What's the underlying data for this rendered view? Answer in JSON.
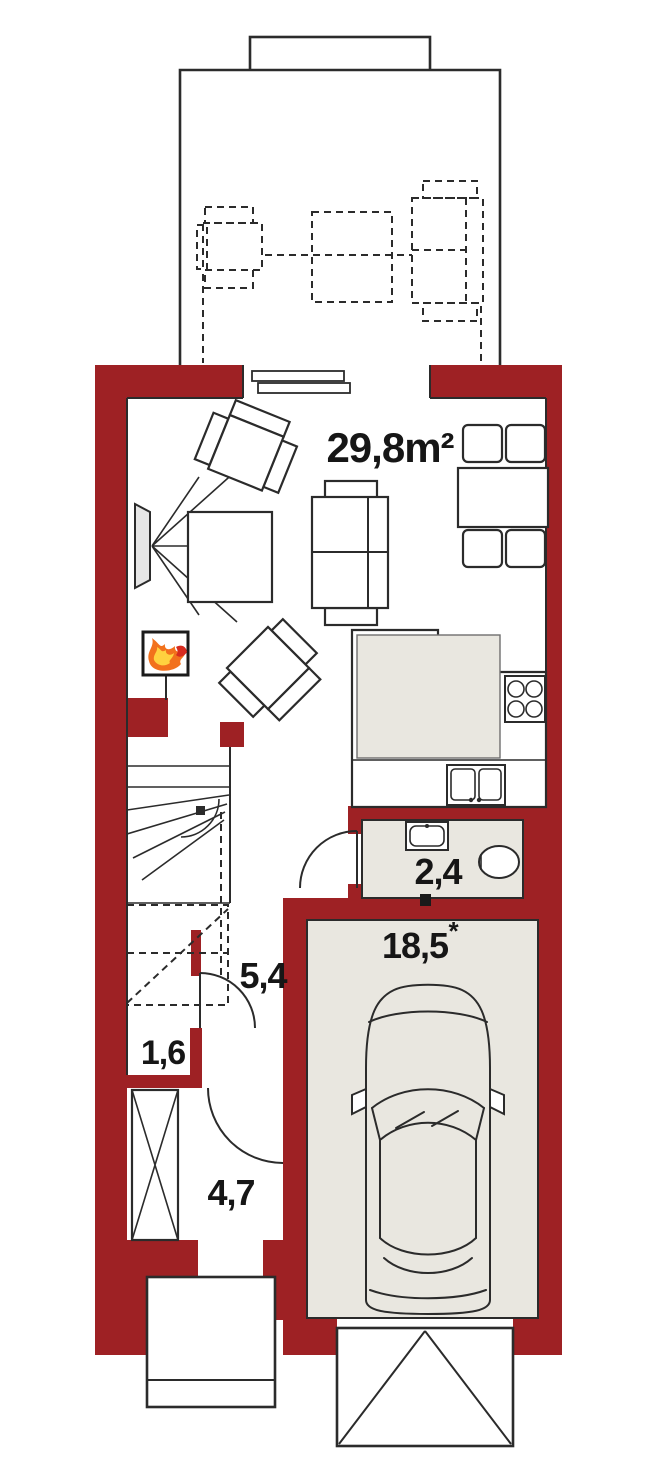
{
  "plan": {
    "rooms": {
      "living": {
        "label": "29,8m²"
      },
      "wc": {
        "label": "2,4"
      },
      "hall": {
        "label": "5,4"
      },
      "storage": {
        "label": "1,6"
      },
      "entry": {
        "label": "4,7"
      },
      "garage": {
        "label": "18,5",
        "asterisk": "*"
      }
    },
    "colors": {
      "wall": "#9e2124",
      "room_fill": "#e9e7e0",
      "line": "#2b2b2b",
      "flame_outer": "#f2711c",
      "flame_inner": "#ffd23f",
      "flame_tip": "#d62b1f"
    },
    "icons": {
      "fireplace": "flame-icon",
      "garage": "car-top-view-icon",
      "stove": "stove-burners-icon",
      "sink": "kitchen-sink-icon",
      "toilet": "toilet-icon",
      "washbasin": "washbasin-icon",
      "tv": "tv-icon",
      "wardrobe": "wardrobe-x-icon",
      "stairs": "staircase-icon",
      "patio_door": "sliding-door-icon"
    }
  }
}
